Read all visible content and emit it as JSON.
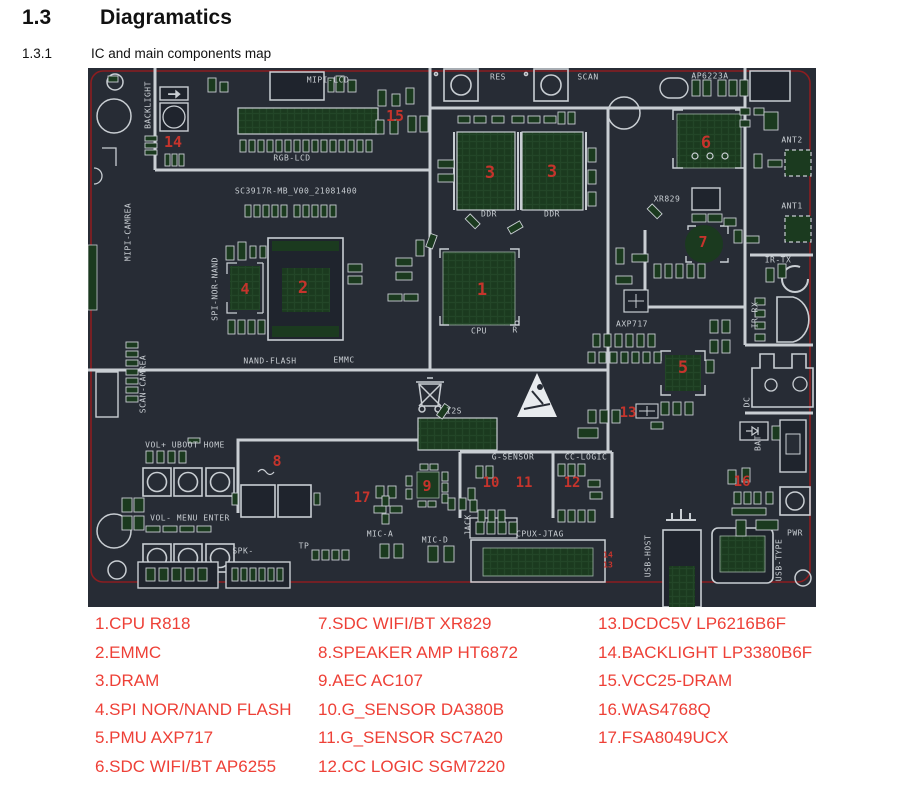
{
  "page": {
    "section_number": "1.3",
    "section_title": "Diagramatics",
    "subsection_number": "1.3.1",
    "subsection_title": "IC and main components map"
  },
  "pcb": {
    "board_name": "SC3917R-MB_V00_21081400",
    "colors": {
      "board_background": "#272c35",
      "silkscreen": "#c9ced3",
      "pad_green": "#1b3a1f",
      "board_outline_red": "#8c1d20",
      "number_red": "#c5342c",
      "legend_red": "#ee4037"
    },
    "silkscreen_labels": [
      {
        "text": "MIPI-LCD",
        "x": 240,
        "y": 12
      },
      {
        "text": "RGB-LCD",
        "x": 204,
        "y": 90
      },
      {
        "text": "RES",
        "x": 410,
        "y": 9
      },
      {
        "text": "SCAN",
        "x": 500,
        "y": 9
      },
      {
        "text": "AP6223A",
        "x": 622,
        "y": 8
      },
      {
        "text": "ANT2",
        "x": 704,
        "y": 72
      },
      {
        "text": "ANT1",
        "x": 704,
        "y": 138
      },
      {
        "text": "XR829",
        "x": 579,
        "y": 131
      },
      {
        "text": "SC3917R-MB_V00_21081400",
        "x": 208,
        "y": 123
      },
      {
        "text": "SPI-NOR-NAND",
        "x": 127,
        "y": 221,
        "vertical": true
      },
      {
        "text": "NAND-FLASH",
        "x": 182,
        "y": 293
      },
      {
        "text": "EMMC",
        "x": 256,
        "y": 292
      },
      {
        "text": "CPU",
        "x": 391,
        "y": 263
      },
      {
        "text": "R",
        "x": 427,
        "y": 262
      },
      {
        "text": "AXP717",
        "x": 544,
        "y": 256
      },
      {
        "text": "DDR",
        "x": 401,
        "y": 146
      },
      {
        "text": "DDR",
        "x": 464,
        "y": 146
      },
      {
        "text": "IR-TX",
        "x": 690,
        "y": 192
      },
      {
        "text": "IR-RX",
        "x": 667,
        "y": 247,
        "vertical": true
      },
      {
        "text": "MIPI-CAMREA",
        "x": 40,
        "y": 164,
        "vertical": true
      },
      {
        "text": "SCAN-CAMREA",
        "x": 55,
        "y": 316,
        "vertical": true
      },
      {
        "text": "BACKLIGHT",
        "x": 60,
        "y": 37,
        "vertical": true
      },
      {
        "text": "VOL+ UBOOT HOME",
        "x": 97,
        "y": 377
      },
      {
        "text": "VOL- MENU ENTER",
        "x": 102,
        "y": 450
      },
      {
        "text": "SPK-",
        "x": 155,
        "y": 483
      },
      {
        "text": "TP",
        "x": 216,
        "y": 478
      },
      {
        "text": "MIC-A",
        "x": 292,
        "y": 466
      },
      {
        "text": "MIC-D",
        "x": 347,
        "y": 472
      },
      {
        "text": "JACK",
        "x": 380,
        "y": 457,
        "vertical": true
      },
      {
        "text": "G-SENSOR",
        "x": 425,
        "y": 389
      },
      {
        "text": "CC-LOGIC",
        "x": 498,
        "y": 389
      },
      {
        "text": "CPUX-JTAG",
        "x": 452,
        "y": 466
      },
      {
        "text": "I2S",
        "x": 366,
        "y": 343
      },
      {
        "text": "USB-HOST",
        "x": 560,
        "y": 488,
        "vertical": true
      },
      {
        "text": "USB-TYPE",
        "x": 691,
        "y": 492,
        "vertical": true
      },
      {
        "text": "PWR",
        "x": 707,
        "y": 465
      },
      {
        "text": "BAT",
        "x": 670,
        "y": 375,
        "vertical": true
      },
      {
        "text": "DC",
        "x": 659,
        "y": 334,
        "vertical": true
      }
    ],
    "component_numbers": [
      {
        "n": "1",
        "x": 394,
        "y": 222,
        "s": 17
      },
      {
        "n": "2",
        "x": 215,
        "y": 220,
        "s": 17
      },
      {
        "n": "3",
        "x": 402,
        "y": 105,
        "s": 17
      },
      {
        "n": "3",
        "x": 464,
        "y": 104,
        "s": 17
      },
      {
        "n": "4",
        "x": 157,
        "y": 221,
        "s": 15
      },
      {
        "n": "5",
        "x": 595,
        "y": 300,
        "s": 17
      },
      {
        "n": "6",
        "x": 618,
        "y": 75,
        "s": 17
      },
      {
        "n": "7",
        "x": 615,
        "y": 174,
        "s": 15
      },
      {
        "n": "8",
        "x": 189,
        "y": 393,
        "s": 15
      },
      {
        "n": "9",
        "x": 339,
        "y": 418,
        "s": 15
      },
      {
        "n": "10",
        "x": 403,
        "y": 415,
        "s": 14
      },
      {
        "n": "11",
        "x": 436,
        "y": 415,
        "s": 14
      },
      {
        "n": "12",
        "x": 484,
        "y": 415,
        "s": 14
      },
      {
        "n": "13",
        "x": 540,
        "y": 345,
        "s": 14
      },
      {
        "n": "14",
        "x": 85,
        "y": 74,
        "s": 15
      },
      {
        "n": "15",
        "x": 307,
        "y": 48,
        "s": 15
      },
      {
        "n": "16",
        "x": 654,
        "y": 414,
        "s": 14
      },
      {
        "n": "17",
        "x": 274,
        "y": 430,
        "s": 14
      },
      {
        "n": "14",
        "x": 520,
        "y": 487,
        "s": 8
      },
      {
        "n": "13",
        "x": 520,
        "y": 497,
        "s": 8
      }
    ]
  },
  "legend": {
    "columns": [
      [
        "1.CPU R818",
        "2.EMMC",
        "3.DRAM",
        "4.SPI NOR/NAND FLASH",
        "5.PMU AXP717",
        "6.SDC WIFI/BT AP6255"
      ],
      [
        "7.SDC WIFI/BT XR829",
        "8.SPEAKER AMP HT6872",
        "9.AEC AC107",
        "10.G_SENSOR DA380B",
        "11.G_SENSOR SC7A20",
        "12.CC LOGIC SGM7220"
      ],
      [
        "13.DCDC5V LP6216B6F",
        "14.BACKLIGHT LP3380B6F",
        "15.VCC25-DRAM",
        "16.WAS4768Q",
        "17.FSA8049UCX"
      ]
    ]
  }
}
